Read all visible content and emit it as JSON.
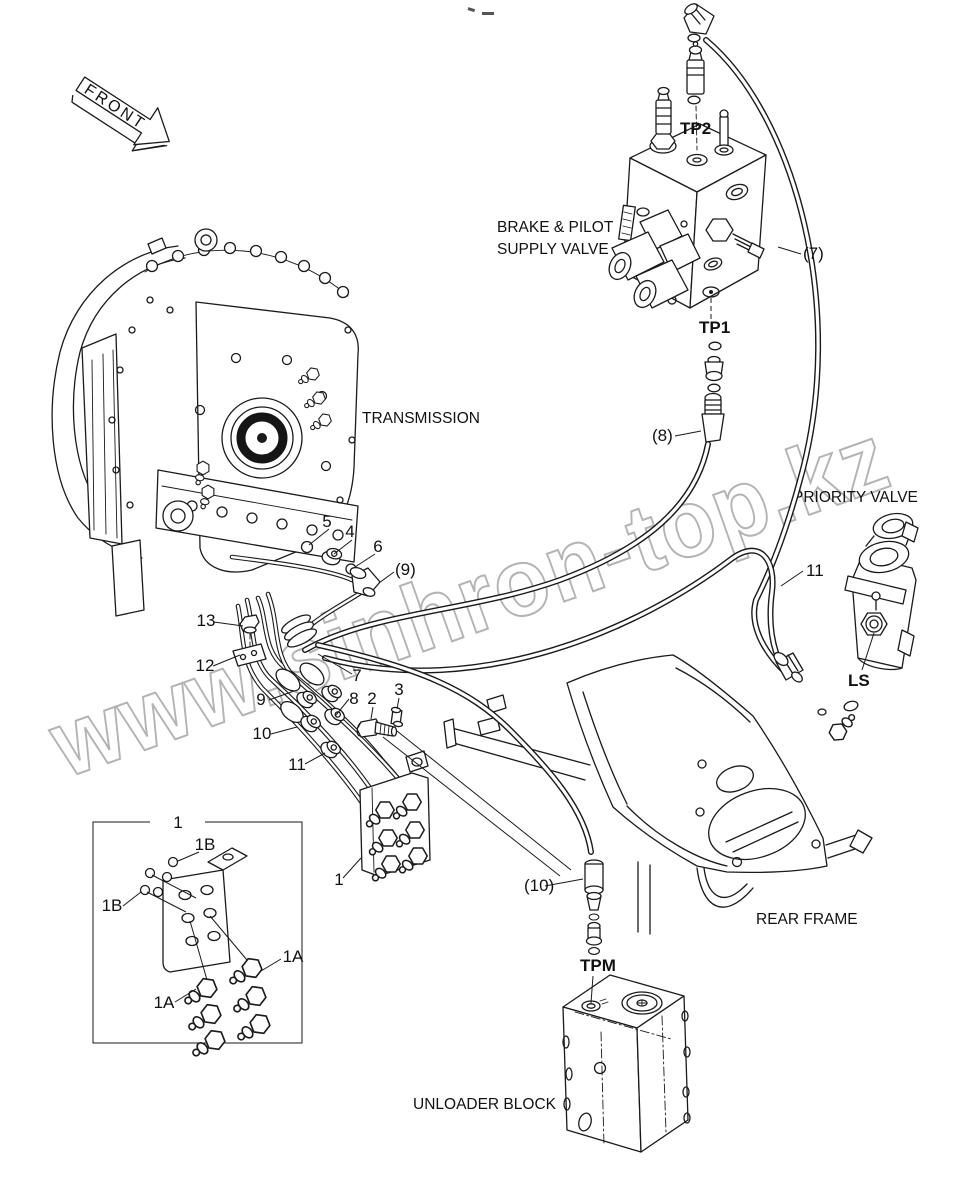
{
  "page": {
    "width": 967,
    "height": 1192,
    "background": "#ffffff",
    "line_color": "#1a1a1a",
    "watermark_color": "#b3b3b3"
  },
  "watermark": {
    "text": "www.sinhron-top.kz"
  },
  "labels": {
    "front": "FRONT",
    "transmission": "TRANSMISSION",
    "brake_pilot_line1": "BRAKE & PILOT",
    "brake_pilot_line2": "SUPPLY VALVE",
    "priority_valve": "PRIORITY VALVE",
    "rear_frame": "REAR FRAME",
    "unloader_block": "UNLOADER BLOCK"
  },
  "ports": {
    "tp2": "TP2",
    "tp1": "TP1",
    "tpm": "TPM",
    "ls": "LS"
  },
  "hose_refs": {
    "h7": "(7)",
    "h8": "(8)",
    "h9": "(9)",
    "h10": "(10)",
    "h11": "11"
  },
  "parts": {
    "p1": "1",
    "p1_inset": "1",
    "p1a_left": "1A",
    "p1a_right": "1A",
    "p1b_top": "1B",
    "p1b_left": "1B",
    "p2": "2",
    "p3": "3",
    "p4": "4",
    "p5": "5",
    "p6": "6",
    "p7": "7",
    "p8": "8",
    "p9": "9",
    "p10": "10",
    "p11": "11",
    "p12": "12",
    "p13": "13"
  }
}
